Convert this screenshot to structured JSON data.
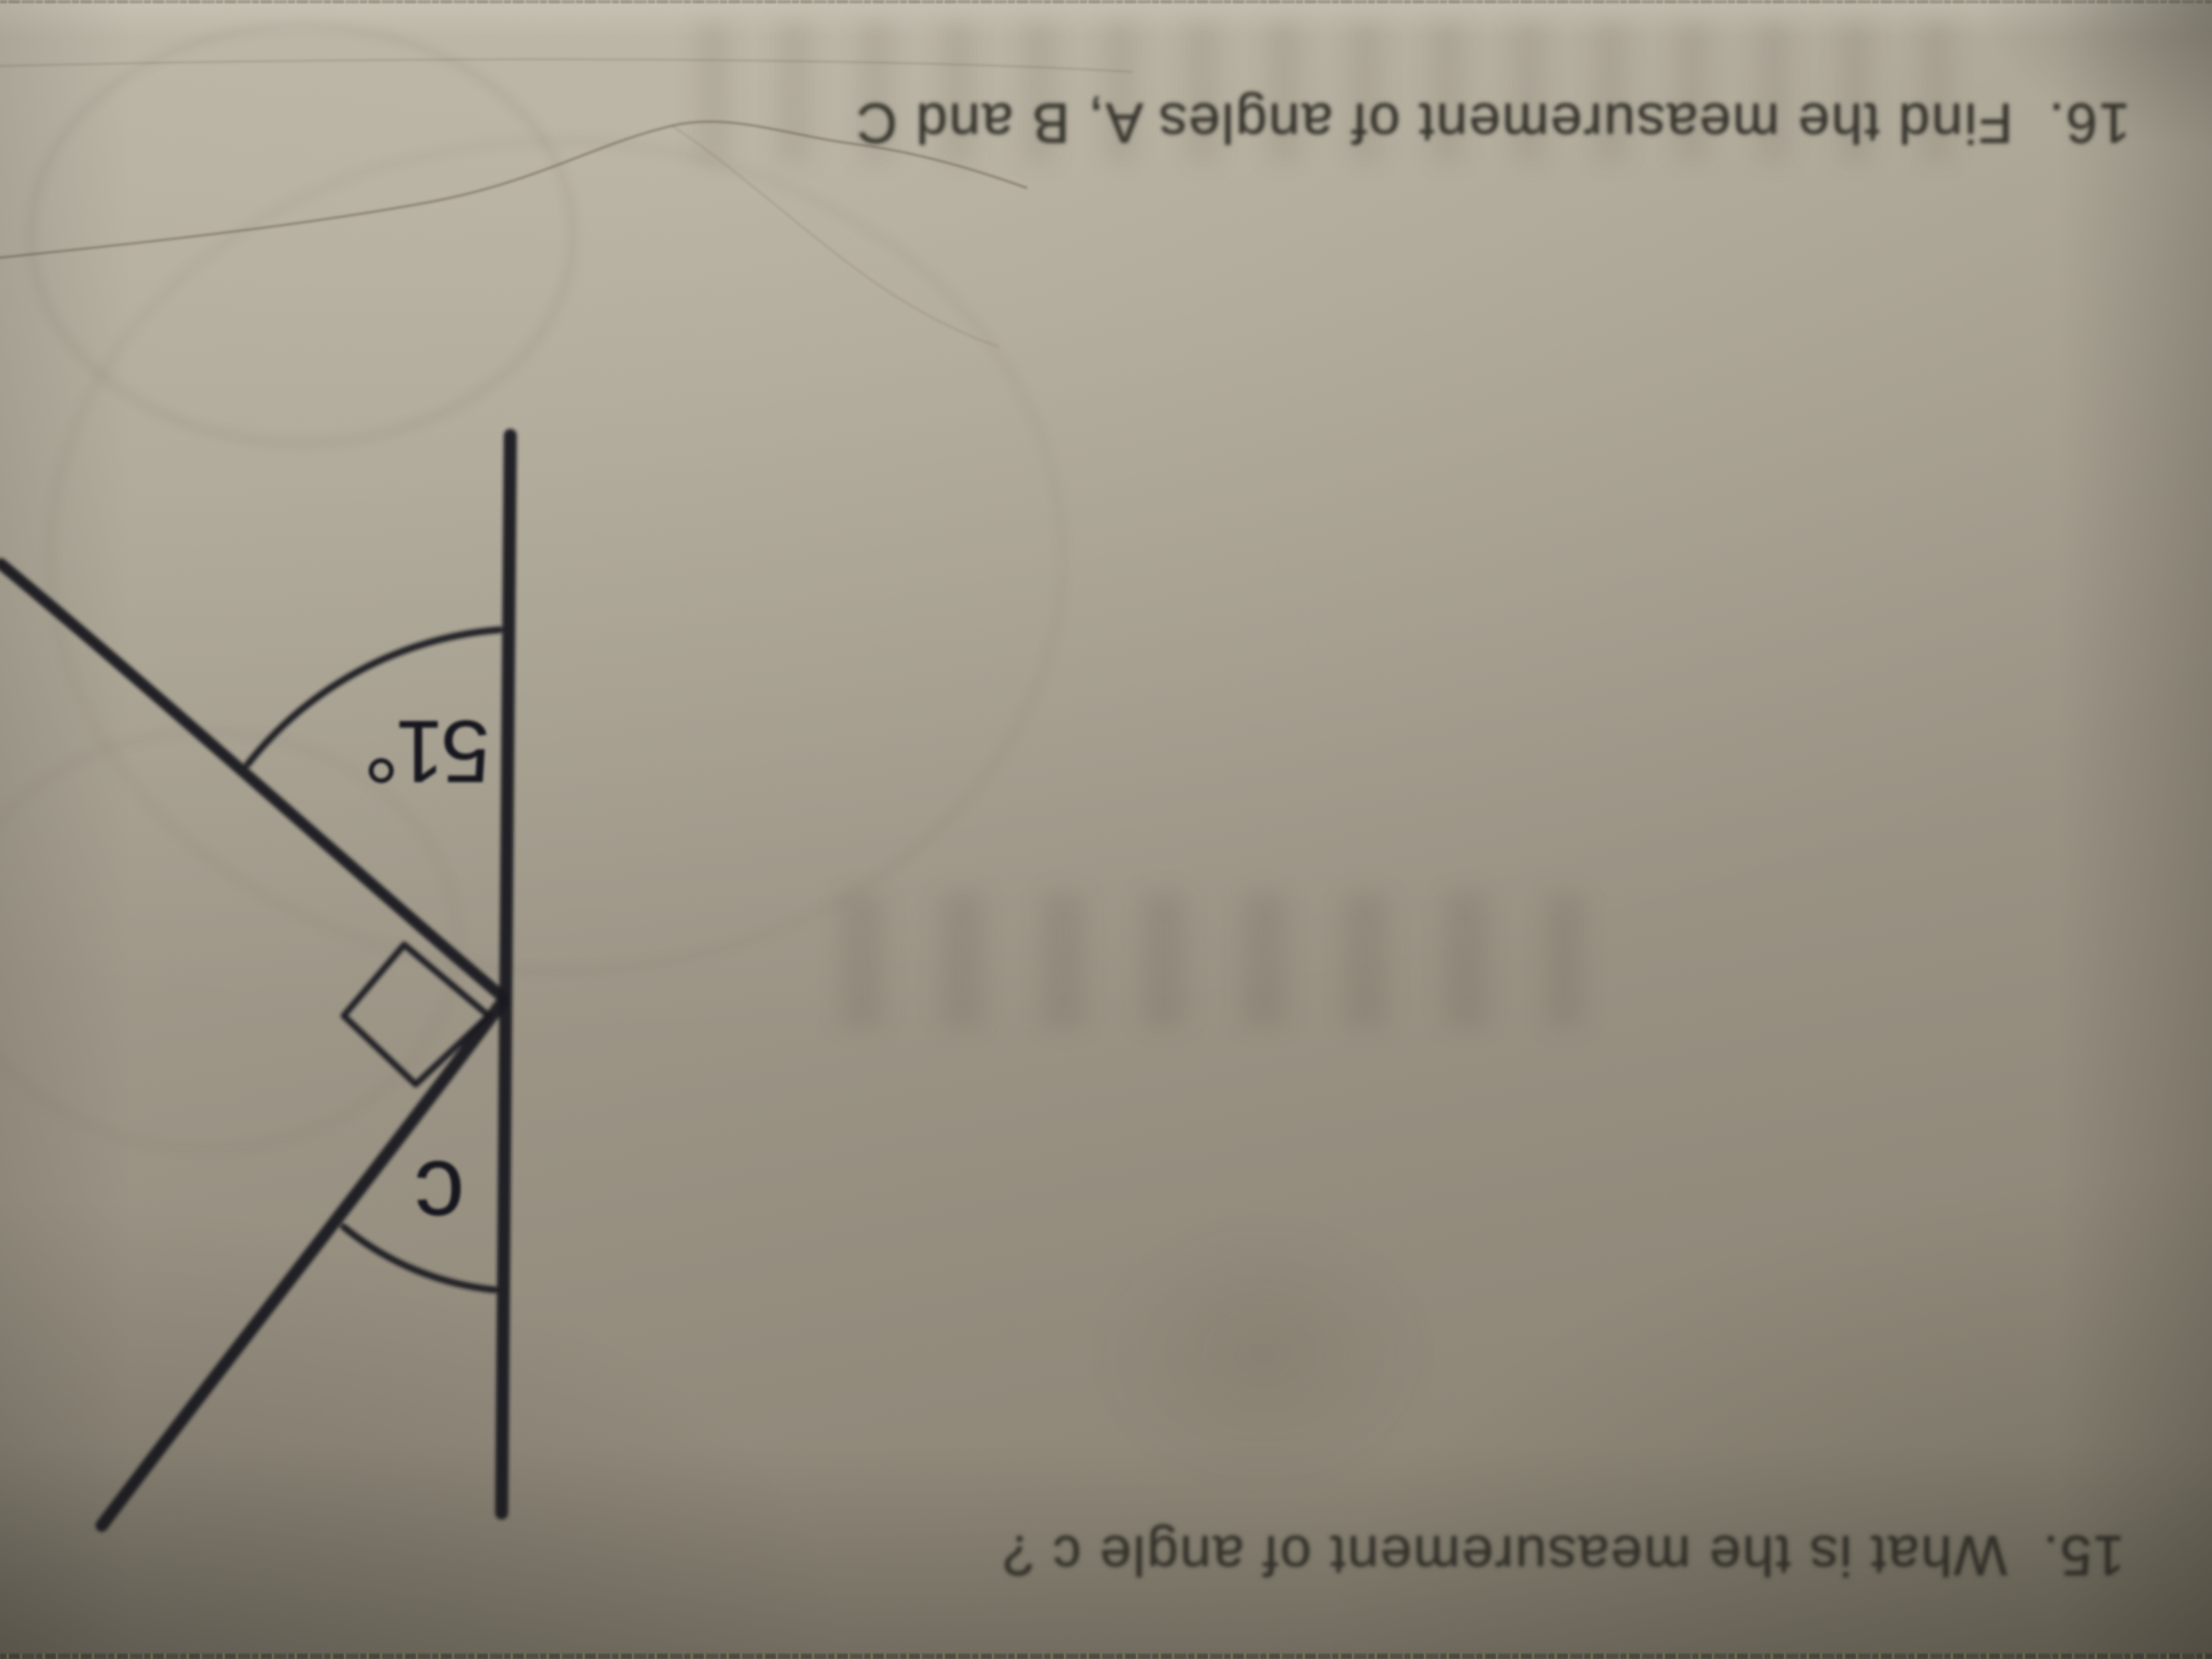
{
  "problems": {
    "p16": "16.  Find the measurement of angles A, B and C",
    "p15": "15.  What is the measurement of angle c ?"
  },
  "diagram": {
    "angle_label_51": "51°",
    "angle_label_c": "c"
  },
  "colors": {
    "paper_light": "#b6b0a0",
    "paper_mid": "#9d9687",
    "paper_dark": "#878170",
    "ink": "#17171f",
    "printed_text": "#38362f"
  }
}
